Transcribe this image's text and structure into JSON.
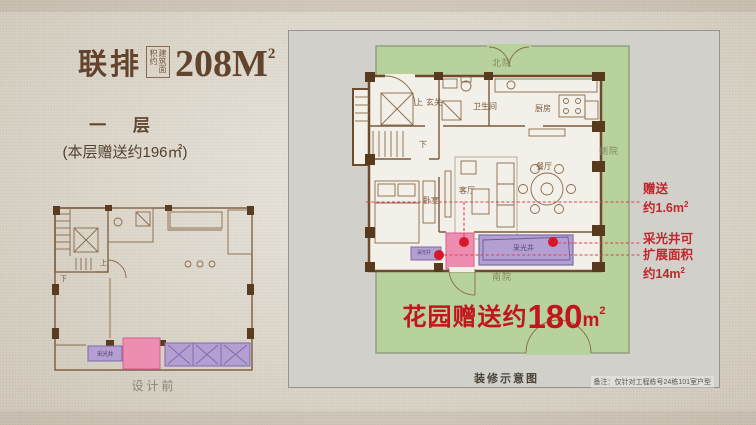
{
  "colors": {
    "accent_red": "#c2151c",
    "marker_red": "#d6182b",
    "title_brown": "#63432c",
    "wall_brown": "#6e4b2c",
    "garden_green": "#b7d29c",
    "lightwell_purple": "#b49fd3",
    "gift_pink": "#ee8db2",
    "panel_gray": "#d2d0ca",
    "background_beige": "#ded8cb"
  },
  "header": {
    "series_label": "联排",
    "area_box_vertical": "建筑面积约",
    "area_value": "208M",
    "area_sup": "2",
    "floor_label": "一 层",
    "floor_bonus": "(本层赠送约196㎡)"
  },
  "left_plan": {
    "up": "上",
    "down": "下",
    "lightwell": "采光井",
    "caption": "设计前"
  },
  "main_plan": {
    "garden": {
      "north": "北院",
      "side": "侧院",
      "south": "南院"
    },
    "rooms": {
      "up": "上",
      "entry": "玄关",
      "bath": "卫生间",
      "kitchen": "厨房",
      "down": "下",
      "living": "客厅",
      "dining": "餐厅",
      "bedroom": "卧室"
    },
    "lightwell": "采光井",
    "lightwell_small": "采光井",
    "gift_banner": {
      "prefix": "花园赠送约",
      "value": "180",
      "unit": "m",
      "sup": "2"
    },
    "annotation1": {
      "line1": "赠送",
      "line2": "约1.6",
      "unit": "m",
      "sup": "2"
    },
    "annotation2": {
      "line1": "采光井可",
      "line2": "扩展面积",
      "line3": "约14",
      "unit": "m",
      "sup": "2"
    },
    "caption": "装修示意图",
    "note": "备注：仅针对工程栋号24栋101室户型"
  }
}
